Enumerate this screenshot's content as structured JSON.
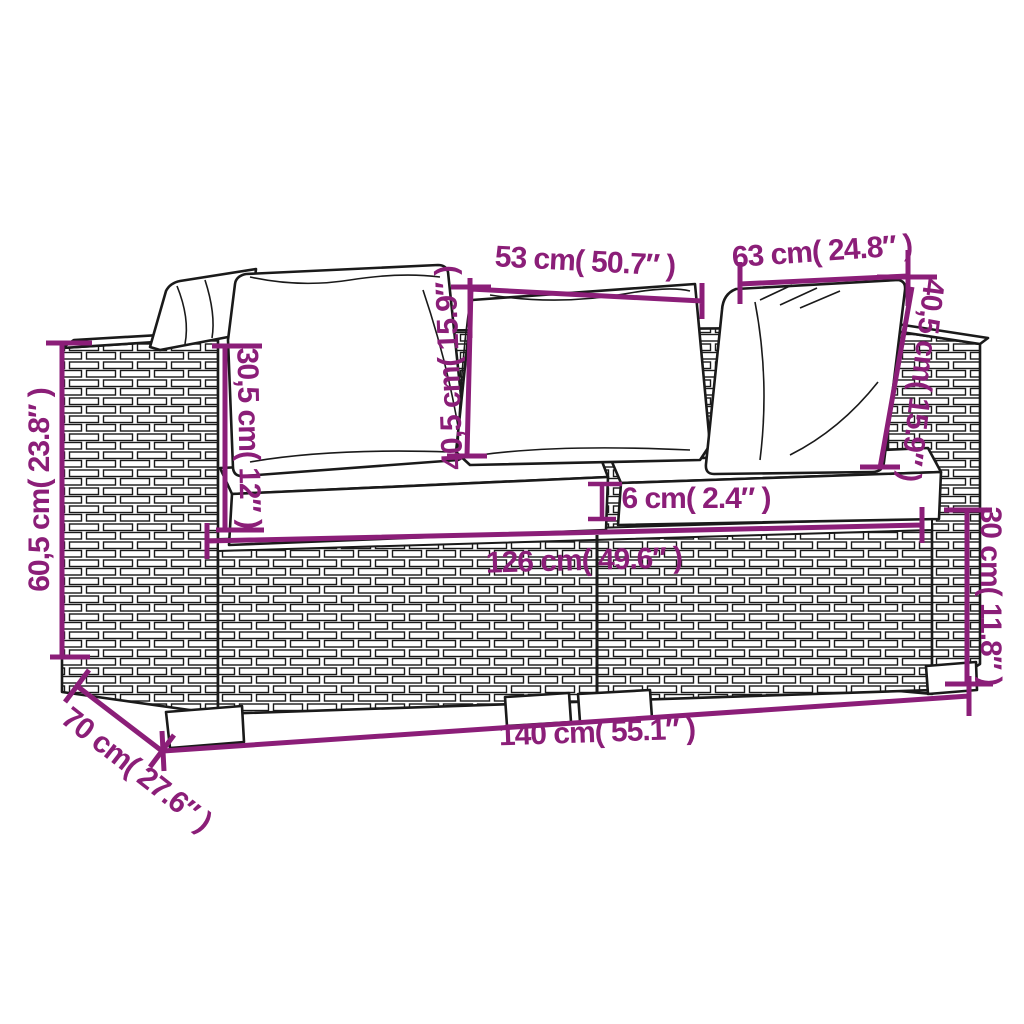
{
  "figure": {
    "kind": "product dimension diagram",
    "subject": "poly rattan 2-seater garden sofa with cushions, line-art drawing",
    "colors": {
      "dimension_accent": "#8B1E78",
      "line_art": "#1a1a1a",
      "background": "#ffffff"
    }
  },
  "dimensions": [
    {
      "name": "center-back-cushion-width",
      "label": "53 cm( 50.7″ )"
    },
    {
      "name": "right-back-cushion-width",
      "label": "63 cm( 24.8″ )"
    },
    {
      "name": "back-cushion-height-center",
      "label": "40,5 cm( 15.9″ )"
    },
    {
      "name": "armrest-above-seat-height",
      "label": "30,5 cm( 12″ )"
    },
    {
      "name": "overall-height",
      "label": "60,5 cm( 23.8″ )"
    },
    {
      "name": "back-cushion-height-right",
      "label": "40,5 cm( 15.9″ )"
    },
    {
      "name": "seat-cushion-thickness",
      "label": "6 cm( 2.4″ )"
    },
    {
      "name": "inner-seat-width",
      "label": "126 cm( 49.6″ )"
    },
    {
      "name": "base-height",
      "label": "30 cm( 11.8″ )"
    },
    {
      "name": "overall-width",
      "label": "140 cm( 55.1″ )"
    },
    {
      "name": "overall-depth",
      "label": "70 cm( 27.6″ )"
    }
  ]
}
